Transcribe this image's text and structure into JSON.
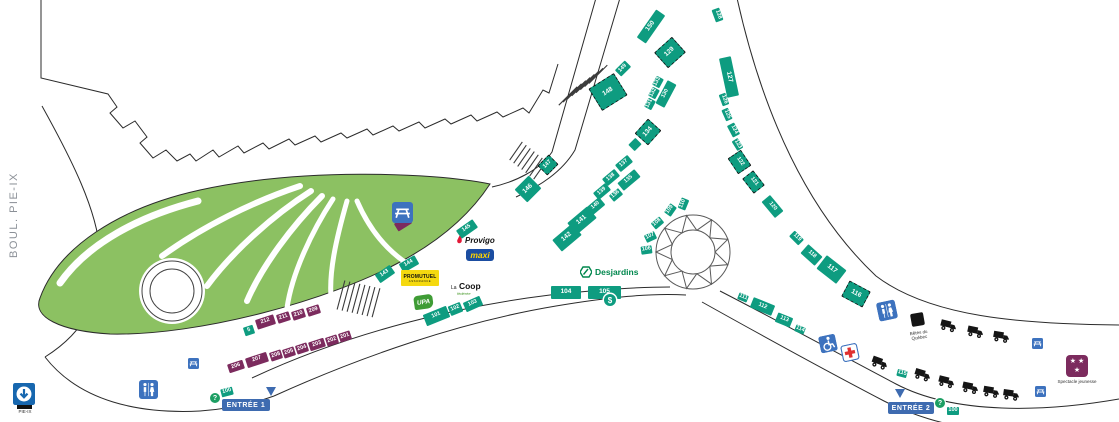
{
  "labels": {
    "street": "BOUL. PIE-IX",
    "metro": "PIE-IX",
    "betes": "Bêtes du Québec",
    "spectacle": "Spectacle jeunesse",
    "question": "?",
    "dollar": "$"
  },
  "entrances": [
    {
      "label": "ENTRÉE 1"
    },
    {
      "label": "ENTRÉE 2"
    }
  ],
  "logos": {
    "provigo": "Provigo",
    "maxi": "maxi",
    "promutuel": "PROMUTUEL",
    "promutuel_sub": "ASSURANCE",
    "lacoop_la": "La",
    "lacoop_coop": "Coop",
    "lacoop_sub": "fédérée",
    "upa": "UPA",
    "desjardins": "Desjardins"
  },
  "colors": {
    "booth_teal": "#0E9C80",
    "booth_purple": "#7C2B5E",
    "park_green": "#8CC162",
    "banner_blue": "#3E6BB0",
    "icon_blue": "#3D72BE",
    "metro_blue": "#1767AF",
    "maxi_blue": "#1B4DA1",
    "maxi_yellow": "#FFD400",
    "promutuel_yellow": "#F5D90F",
    "desjardins_green": "#00874D",
    "provigo_red": "#E31837"
  },
  "booths": [
    {
      "n": "100",
      "x": 221,
      "y": 388,
      "w": 12,
      "h": 8,
      "r": -15
    },
    {
      "n": "101",
      "x": 424,
      "y": 310,
      "w": 25,
      "h": 12,
      "r": -22
    },
    {
      "n": "102",
      "x": 449,
      "y": 304,
      "w": 13,
      "h": 10,
      "r": -22
    },
    {
      "n": "103",
      "x": 464,
      "y": 299,
      "w": 18,
      "h": 10,
      "r": -24
    },
    {
      "n": "104",
      "x": 551,
      "y": 286,
      "w": 30,
      "h": 13,
      "r": 0
    },
    {
      "n": "105",
      "x": 588,
      "y": 286,
      "w": 33,
      "h": 13,
      "r": 0
    },
    {
      "n": "106",
      "x": 641,
      "y": 246,
      "w": 11,
      "h": 8,
      "r": -8
    },
    {
      "n": "107",
      "x": 645,
      "y": 233,
      "w": 11,
      "h": 8,
      "r": -25
    },
    {
      "n": "108",
      "x": 652,
      "y": 219,
      "w": 11,
      "h": 8,
      "r": -40
    },
    {
      "n": "109",
      "x": 665,
      "y": 206,
      "w": 11,
      "h": 8,
      "r": -55
    },
    {
      "n": "110",
      "x": 678,
      "y": 200,
      "w": 11,
      "h": 8,
      "r": -68
    },
    {
      "n": "111",
      "x": 738,
      "y": 294,
      "w": 10,
      "h": 7,
      "r": 22
    },
    {
      "n": "112",
      "x": 751,
      "y": 301,
      "w": 23,
      "h": 11,
      "r": 22
    },
    {
      "n": "113",
      "x": 776,
      "y": 315,
      "w": 16,
      "h": 10,
      "r": 22
    },
    {
      "n": "114",
      "x": 795,
      "y": 326,
      "w": 10,
      "h": 7,
      "r": 22
    },
    {
      "n": "115",
      "x": 897,
      "y": 370,
      "w": 10,
      "h": 7,
      "r": 15
    },
    {
      "n": "116",
      "x": 844,
      "y": 285,
      "w": 24,
      "h": 18,
      "r": 28,
      "d": 1
    },
    {
      "n": "117",
      "x": 819,
      "y": 261,
      "w": 25,
      "h": 17,
      "r": 38
    },
    {
      "n": "118",
      "x": 802,
      "y": 249,
      "w": 19,
      "h": 12,
      "r": 42
    },
    {
      "n": "119",
      "x": 790,
      "y": 234,
      "w": 13,
      "h": 8,
      "r": 45
    },
    {
      "n": "120",
      "x": 762,
      "y": 201,
      "w": 21,
      "h": 11,
      "r": 50
    },
    {
      "n": "121",
      "x": 744,
      "y": 175,
      "w": 19,
      "h": 14,
      "r": 52,
      "d": 1
    },
    {
      "n": "122",
      "x": 730,
      "y": 154,
      "w": 19,
      "h": 16,
      "r": 56,
      "d": 1
    },
    {
      "n": "123",
      "x": 732,
      "y": 141,
      "w": 11,
      "h": 7,
      "r": 58
    },
    {
      "n": "124",
      "x": 727,
      "y": 126,
      "w": 13,
      "h": 8,
      "r": 62
    },
    {
      "n": "125",
      "x": 721,
      "y": 111,
      "w": 12,
      "h": 7,
      "r": 66
    },
    {
      "n": "126",
      "x": 718,
      "y": 96,
      "w": 12,
      "h": 7,
      "r": 70
    },
    {
      "n": "127",
      "x": 709,
      "y": 71,
      "w": 40,
      "h": 12,
      "r": 78
    },
    {
      "n": "128",
      "x": 711,
      "y": 11,
      "w": 13,
      "h": 8,
      "r": 70
    },
    {
      "n": "129",
      "x": 658,
      "y": 42,
      "w": 24,
      "h": 21,
      "r": -42,
      "d": 1
    },
    {
      "n": "130",
      "x": 653,
      "y": 89,
      "w": 26,
      "h": 10,
      "r": -62
    },
    {
      "n": "131",
      "x": 645,
      "y": 100,
      "w": 10,
      "h": 8,
      "r": -62
    },
    {
      "n": "132",
      "x": 649,
      "y": 89,
      "w": 10,
      "h": 8,
      "r": -62
    },
    {
      "n": "133",
      "x": 653,
      "y": 78,
      "w": 10,
      "h": 8,
      "r": -62
    },
    {
      "n": "134",
      "x": 638,
      "y": 123,
      "w": 20,
      "h": 18,
      "r": -48,
      "d": 1
    },
    {
      "n": "",
      "x": 630,
      "y": 140,
      "w": 10,
      "h": 9,
      "r": -45
    },
    {
      "n": "135",
      "x": 618,
      "y": 175,
      "w": 22,
      "h": 10,
      "r": -40
    },
    {
      "n": "136",
      "x": 610,
      "y": 191,
      "w": 12,
      "h": 8,
      "r": -40
    },
    {
      "n": "137",
      "x": 616,
      "y": 159,
      "w": 16,
      "h": 9,
      "r": -40
    },
    {
      "n": "138",
      "x": 603,
      "y": 173,
      "w": 16,
      "h": 9,
      "r": -40
    },
    {
      "n": "139",
      "x": 594,
      "y": 187,
      "w": 16,
      "h": 9,
      "r": -40
    },
    {
      "n": "140",
      "x": 588,
      "y": 201,
      "w": 16,
      "h": 10,
      "r": -40
    },
    {
      "n": "141",
      "x": 569,
      "y": 213,
      "w": 26,
      "h": 15,
      "r": -40
    },
    {
      "n": "142",
      "x": 554,
      "y": 230,
      "w": 26,
      "h": 15,
      "r": -40
    },
    {
      "n": "143",
      "x": 376,
      "y": 269,
      "w": 18,
      "h": 10,
      "r": -35
    },
    {
      "n": "144",
      "x": 400,
      "y": 259,
      "w": 18,
      "h": 10,
      "r": -30
    },
    {
      "n": "145",
      "x": 457,
      "y": 224,
      "w": 20,
      "h": 10,
      "r": -35
    },
    {
      "n": "146",
      "x": 518,
      "y": 180,
      "w": 20,
      "h": 18,
      "r": -45
    },
    {
      "n": "147",
      "x": 540,
      "y": 158,
      "w": 16,
      "h": 14,
      "r": -45,
      "d": 1
    },
    {
      "n": "148",
      "x": 593,
      "y": 79,
      "w": 30,
      "h": 26,
      "r": -32,
      "d": 1
    },
    {
      "n": "149",
      "x": 616,
      "y": 64,
      "w": 14,
      "h": 9,
      "r": -45
    },
    {
      "n": "150",
      "x": 634,
      "y": 21,
      "w": 34,
      "h": 11,
      "r": -55
    },
    {
      "n": "5",
      "x": 244,
      "y": 326,
      "w": 10,
      "h": 9,
      "r": -18
    },
    {
      "n": "100",
      "x": 947,
      "y": 407,
      "w": 12,
      "h": 8,
      "r": 0
    },
    {
      "n": "201",
      "x": 339,
      "y": 332,
      "w": 12,
      "h": 9,
      "r": -18,
      "c": "p"
    },
    {
      "n": "202",
      "x": 326,
      "y": 336,
      "w": 12,
      "h": 9,
      "r": -18,
      "c": "p"
    },
    {
      "n": "203",
      "x": 309,
      "y": 340,
      "w": 16,
      "h": 9,
      "r": -18,
      "c": "p"
    },
    {
      "n": "204",
      "x": 296,
      "y": 344,
      "w": 12,
      "h": 9,
      "r": -18,
      "c": "p"
    },
    {
      "n": "205",
      "x": 283,
      "y": 348,
      "w": 12,
      "h": 9,
      "r": -18,
      "c": "p"
    },
    {
      "n": "208",
      "x": 270,
      "y": 351,
      "w": 12,
      "h": 9,
      "r": -18,
      "c": "p"
    },
    {
      "n": "207",
      "x": 246,
      "y": 355,
      "w": 22,
      "h": 10,
      "r": -18,
      "c": "p"
    },
    {
      "n": "206",
      "x": 228,
      "y": 362,
      "w": 16,
      "h": 9,
      "r": -18,
      "c": "p"
    },
    {
      "n": "209",
      "x": 307,
      "y": 306,
      "w": 13,
      "h": 9,
      "r": -18,
      "c": "p"
    },
    {
      "n": "210",
      "x": 292,
      "y": 310,
      "w": 13,
      "h": 9,
      "r": -18,
      "c": "p"
    },
    {
      "n": "211",
      "x": 277,
      "y": 313,
      "w": 13,
      "h": 9,
      "r": -18,
      "c": "p"
    },
    {
      "n": "212",
      "x": 256,
      "y": 317,
      "w": 19,
      "h": 10,
      "r": -18,
      "c": "p"
    },
    {
      "n": "",
      "x": 395,
      "y": 219,
      "w": 16,
      "h": 9,
      "r": -32,
      "c": "p"
    }
  ],
  "icons": [
    {
      "t": "metro",
      "x": 13,
      "y": 383,
      "s": 22
    },
    {
      "t": "toilets",
      "x": 139,
      "y": 380,
      "s": 19
    },
    {
      "t": "picnic",
      "x": 188,
      "y": 356,
      "s": 11
    },
    {
      "t": "picnic",
      "x": 392,
      "y": 202,
      "s": 21
    },
    {
      "t": "question",
      "x": 210,
      "y": 393,
      "s": 10
    },
    {
      "t": "arrow",
      "x": 266,
      "y": 387,
      "s": 11
    },
    {
      "t": "toilets",
      "x": 878,
      "y": 301,
      "s": 19,
      "r": -12
    },
    {
      "t": "blacksq",
      "x": 911,
      "y": 313,
      "s": 13,
      "r": -10
    },
    {
      "t": "truck",
      "x": 939,
      "y": 319,
      "s": 18,
      "r": 14
    },
    {
      "t": "truck",
      "x": 966,
      "y": 325,
      "s": 18,
      "r": 12
    },
    {
      "t": "truck",
      "x": 992,
      "y": 330,
      "s": 18,
      "r": 10
    },
    {
      "t": "picnic",
      "x": 1032,
      "y": 336,
      "s": 11
    },
    {
      "t": "wheelchair",
      "x": 820,
      "y": 335,
      "s": 17,
      "r": -12
    },
    {
      "t": "firstaid",
      "x": 842,
      "y": 344,
      "s": 17,
      "r": -12
    },
    {
      "t": "truck",
      "x": 870,
      "y": 356,
      "s": 18,
      "r": 20
    },
    {
      "t": "truck",
      "x": 913,
      "y": 368,
      "s": 18,
      "r": 17
    },
    {
      "t": "truck",
      "x": 937,
      "y": 375,
      "s": 18,
      "r": 14
    },
    {
      "t": "truck",
      "x": 961,
      "y": 381,
      "s": 18,
      "r": 12
    },
    {
      "t": "truck",
      "x": 982,
      "y": 385,
      "s": 18,
      "r": 10
    },
    {
      "t": "truck",
      "x": 1002,
      "y": 388,
      "s": 18,
      "r": 8
    },
    {
      "t": "picnic",
      "x": 1035,
      "y": 384,
      "s": 11
    },
    {
      "t": "spectacle",
      "x": 1066,
      "y": 355,
      "s": 22
    },
    {
      "t": "arrow",
      "x": 895,
      "y": 389,
      "s": 11
    },
    {
      "t": "question",
      "x": 935,
      "y": 398,
      "s": 10
    },
    {
      "t": "dollar",
      "x": 604,
      "y": 294,
      "s": 12
    }
  ]
}
